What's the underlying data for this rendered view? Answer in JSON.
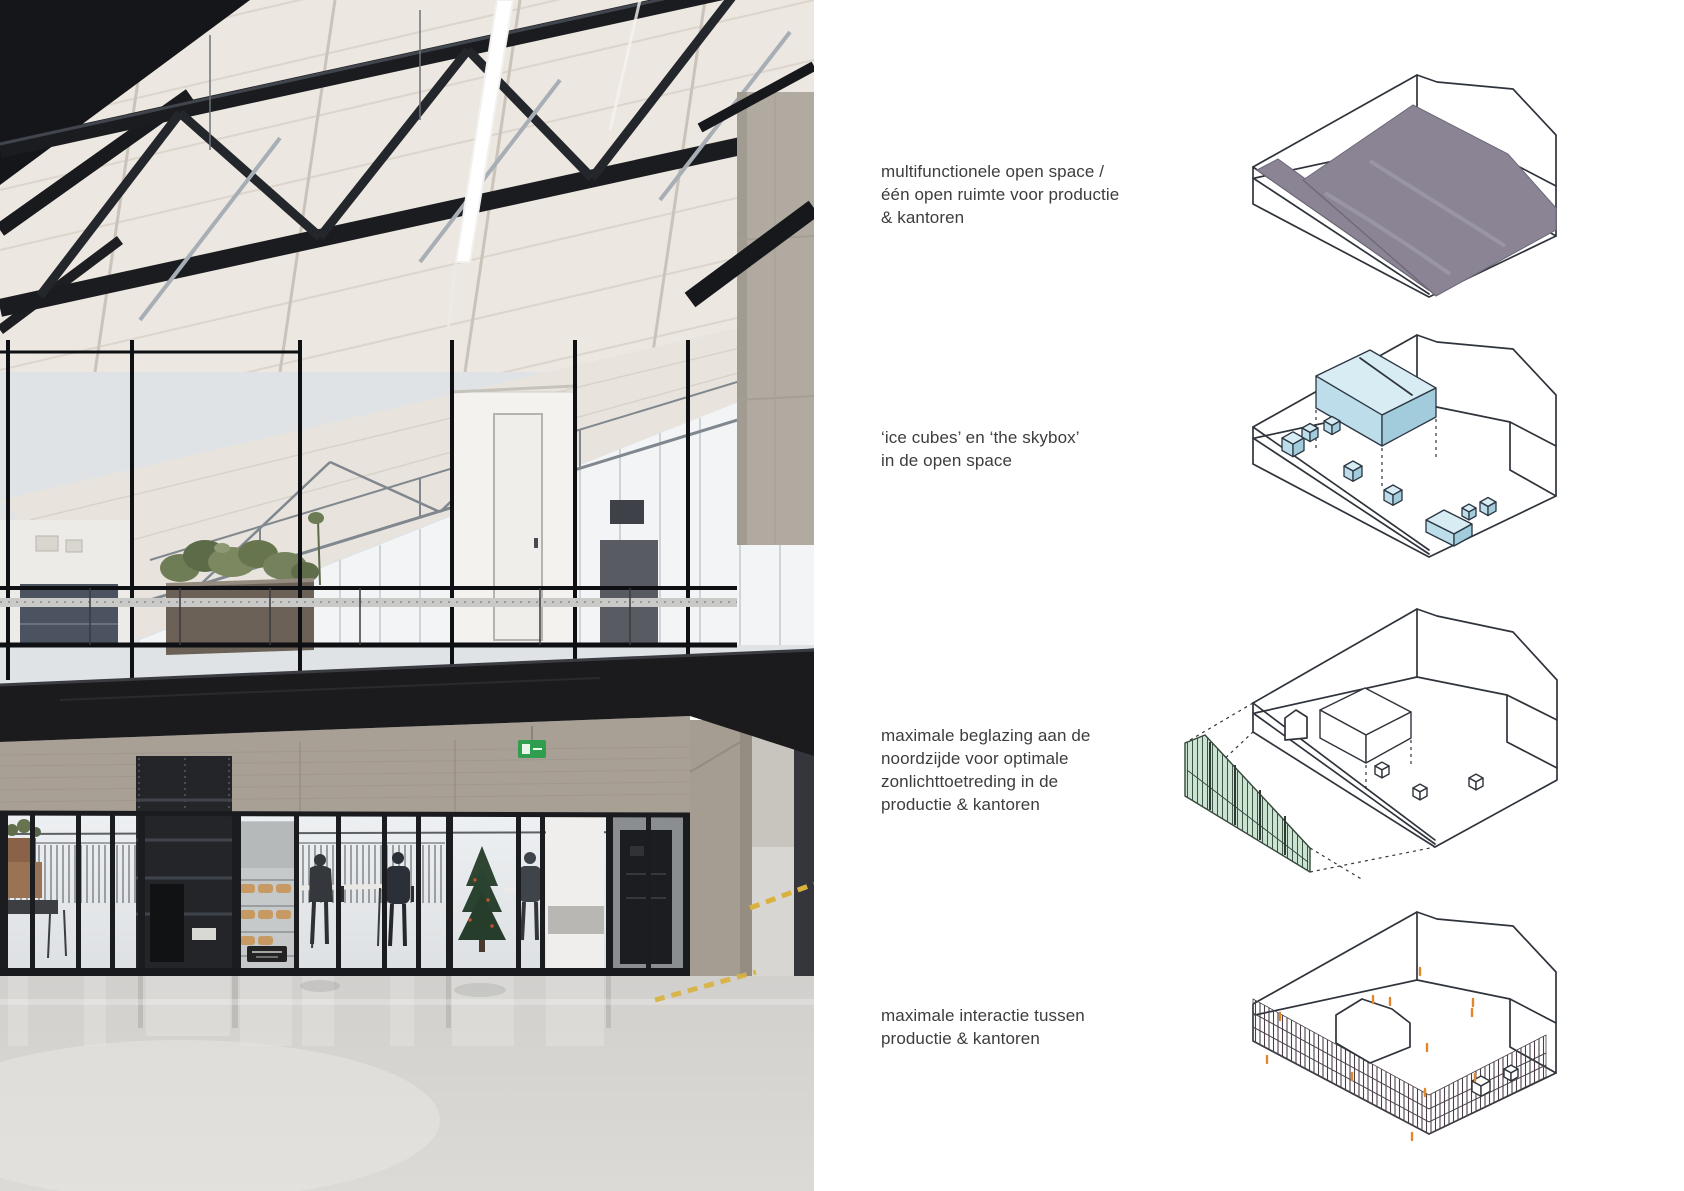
{
  "page": {
    "background": "#ffffff"
  },
  "colors": {
    "page-bg": "#ffffff",
    "caption-text": "#3d3d3d",
    "sketch-line": "#2f343c",
    "floorplate-gray": "#8a8494",
    "cube-top": "#d7ecf3",
    "cube-left": "#bcdde9",
    "cube-right": "#a2cbdb",
    "glazing-green": "#cbe4d2",
    "person-orange": "#e0882e",
    "exit-green": "#2f9e4f",
    "hazard-yellow": "#d9b23e"
  },
  "photo": {
    "description": "Industrial interior: black steel roof trusses under white roof panels, glazed mezzanine offices with planter, black mezzanine beam, concrete walls, glazed cafe front with people, polished concrete floor"
  },
  "panels": [
    {
      "diagram": "open-space-floorplate",
      "caption_lines": [
        "multifunctionele open space /",
        "één open ruimte voor productie",
        "& kantoren"
      ]
    },
    {
      "diagram": "ice-cubes-and-skybox",
      "caption_lines": [
        "‘ice cubes’ en ‘the skybox’",
        "in de open space"
      ]
    },
    {
      "diagram": "north-facade-glazing",
      "caption_lines": [
        "maximale beglazing aan de",
        "noordzijde voor optimale",
        "zonlichttoetreding in de",
        "productie & kantoren"
      ]
    },
    {
      "diagram": "production-office-interaction",
      "caption_lines": [
        "maximale interactie tussen",
        "productie & kantoren"
      ]
    }
  ]
}
